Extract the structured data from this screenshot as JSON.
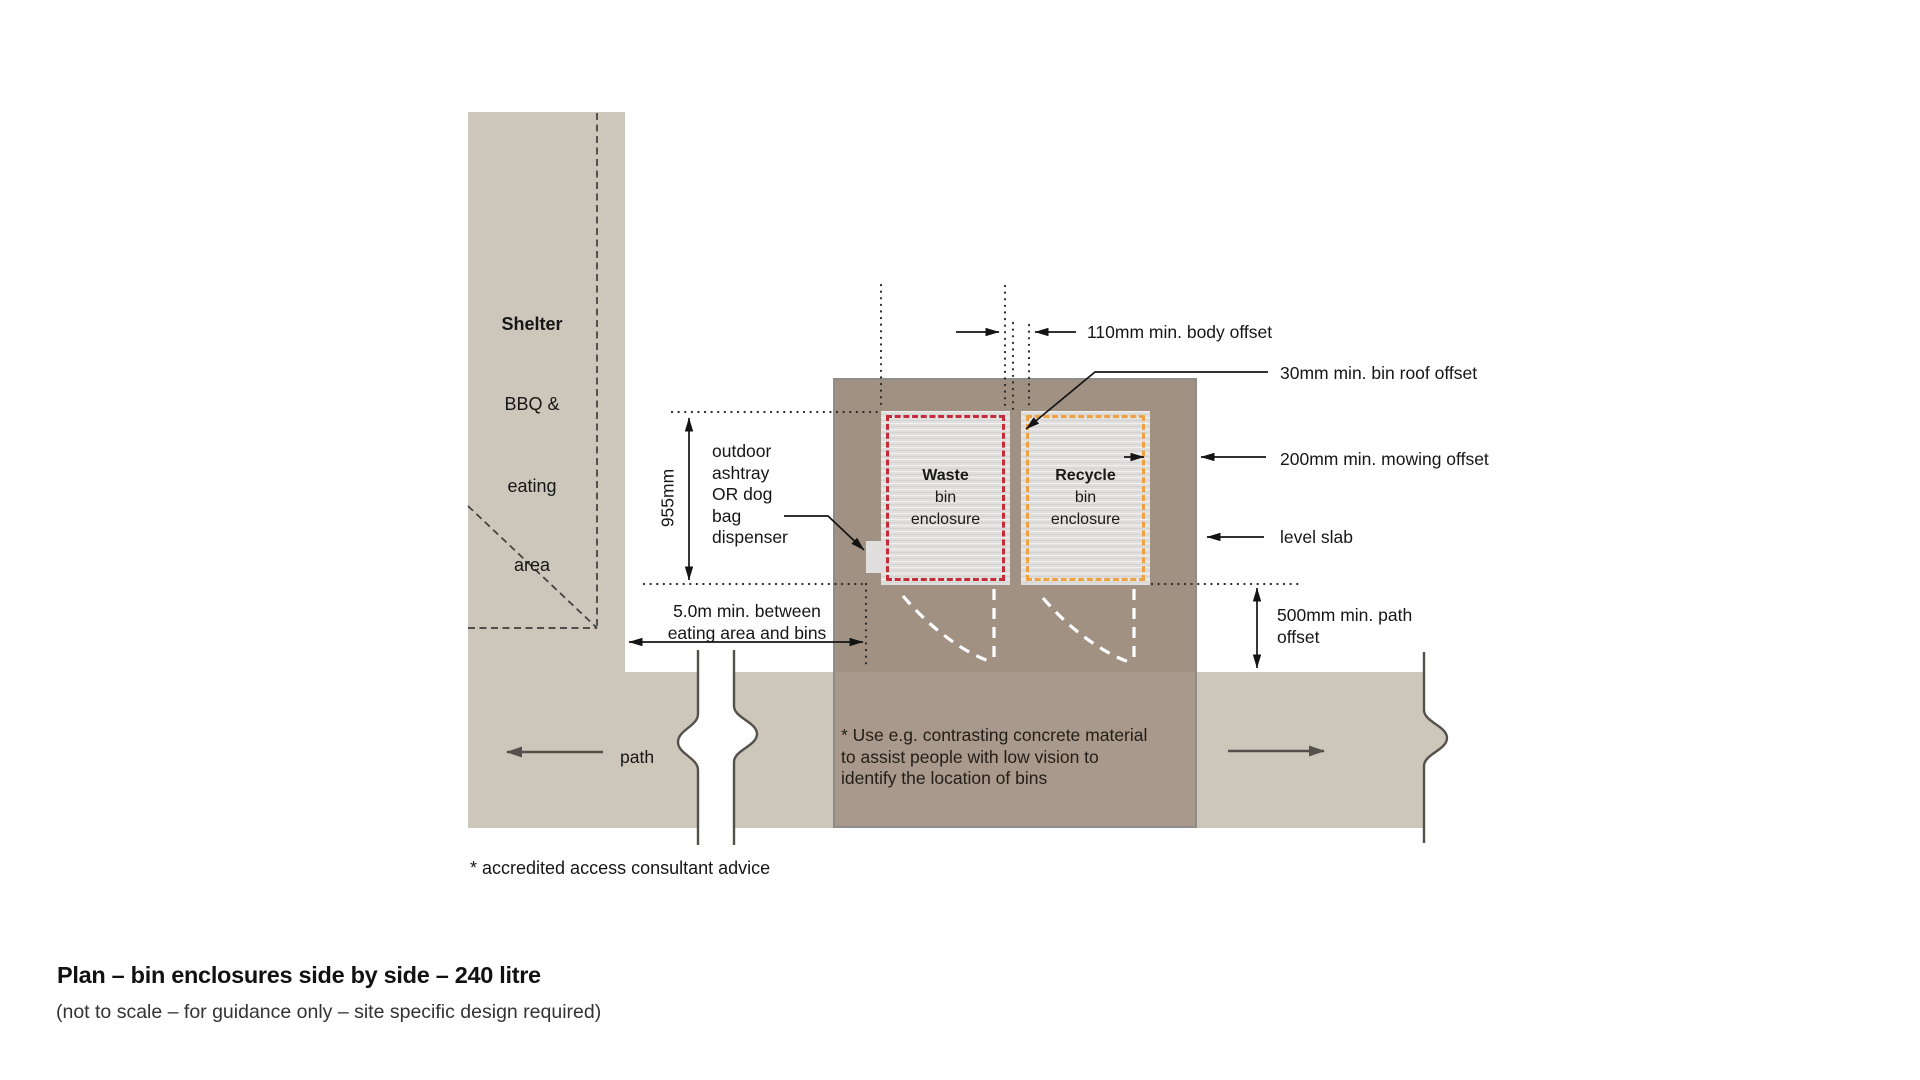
{
  "colors": {
    "surface": "#cdc7bb",
    "slab": "#a19183",
    "slab_border": "#8f8d89",
    "pad": "#e0dfdd",
    "waste_red": "#c62b38",
    "recycle_orange": "#f0a140",
    "line_dark": "#141414",
    "line_gray": "#54504b",
    "text": "#1a1a1a"
  },
  "title": {
    "heading": "Plan – bin enclosures side by side – 240 litre",
    "subheading": "(not to scale – for guidance only – site specific design required)"
  },
  "shelter": {
    "line1": "Shelter",
    "line2": "BBQ &",
    "line3": "eating",
    "line4": "area"
  },
  "bins": {
    "waste": {
      "name": "Waste",
      "line2": "bin",
      "line3": "enclosure"
    },
    "recycle": {
      "name": "Recycle",
      "line2": "bin",
      "line3": "enclosure"
    }
  },
  "dimensions": {
    "enclosure_depth": "955mm",
    "body_offset": "110mm min. body offset",
    "roof_offset": "30mm min. bin roof offset",
    "mowing_offset": "200mm min. mowing offset",
    "level_slab": "level slab",
    "path_offset": "500mm min. path\noffset",
    "eating_distance": "5.0m min. between\neating area and bins"
  },
  "labels": {
    "path": "path",
    "dispenser": "outdoor\nashtray\nOR dog\nbag\ndispenser",
    "slab_note": "* Use e.g. contrasting concrete material\nto assist people with low vision to\nidentify the location of bins",
    "footnote": "* accredited access consultant advice"
  }
}
